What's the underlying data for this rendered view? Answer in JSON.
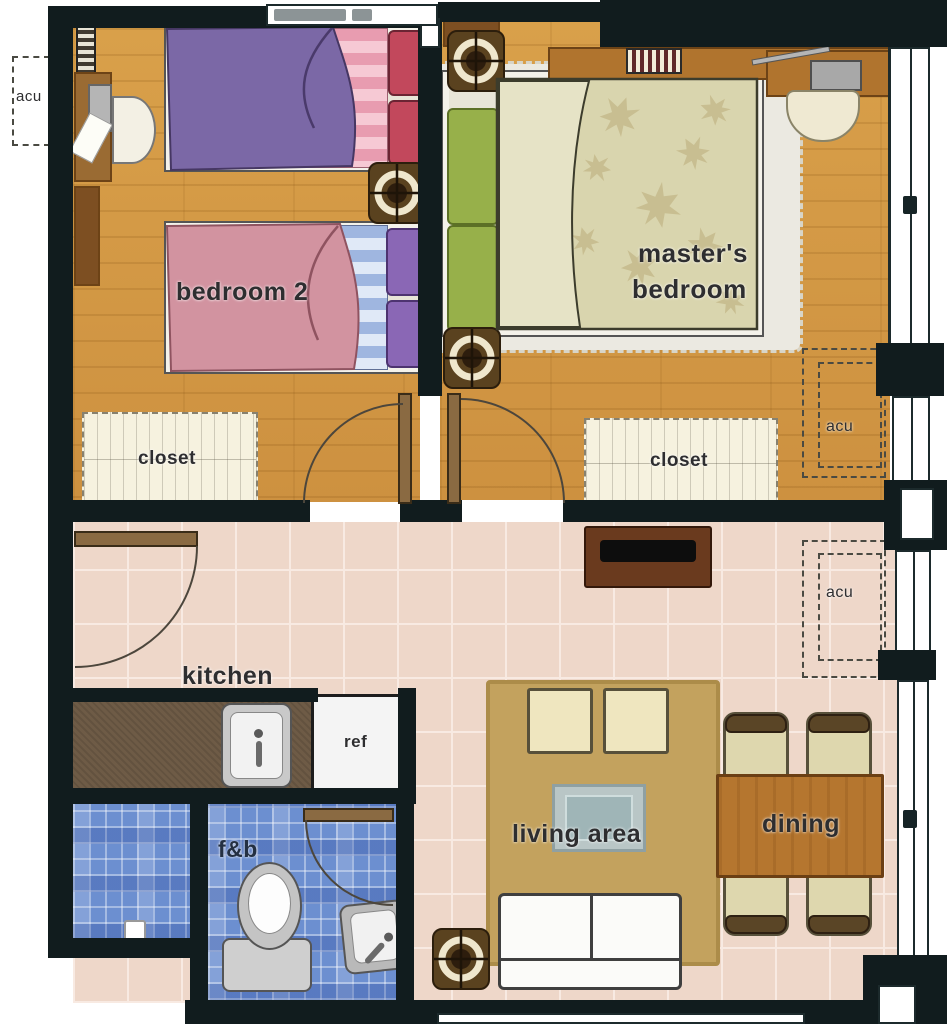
{
  "plan": {
    "title": "apartment unit floor plan",
    "rooms": {
      "bedroom2": {
        "name": "bedroom 2",
        "closet": "closet"
      },
      "master_bedroom": {
        "name_line1": "master's",
        "name_line2": "bedroom",
        "closet": "closet"
      },
      "kitchen": {
        "name": "kitchen",
        "ref": "ref"
      },
      "toilet_bath": {
        "name": "f&b"
      },
      "living_area": {
        "name": "living area"
      },
      "dining": {
        "name": "dining"
      }
    },
    "annotations": {
      "acu": "acu"
    },
    "fixtures": [
      "sprinkler-icon",
      "toilet-icon",
      "bath-sink-icon",
      "kitchen-sink-icon",
      "refrigerator",
      "tv-console",
      "sofa",
      "coffee-table",
      "armchair-cushion",
      "dining-table",
      "dining-chair",
      "bed",
      "closet",
      "desk",
      "chair",
      "vent-grille",
      "door",
      "window"
    ],
    "colors": {
      "wall": "#111c1e",
      "wood_floor": "#d39b45",
      "tile_floor": "#eed7c9",
      "bath_tile": "#6c8fd0",
      "counter": "#6e5b46",
      "rug_living": "#c3a25e",
      "table_wood": "#b5762f",
      "blanket_purple": "#7b68a6",
      "blanket_pink": "#d293a0",
      "pillow_red": "#c2485c",
      "pillow_purple": "#8a67b5",
      "pillow_green": "#97b04a",
      "duvet": "#d9d5ae"
    }
  }
}
